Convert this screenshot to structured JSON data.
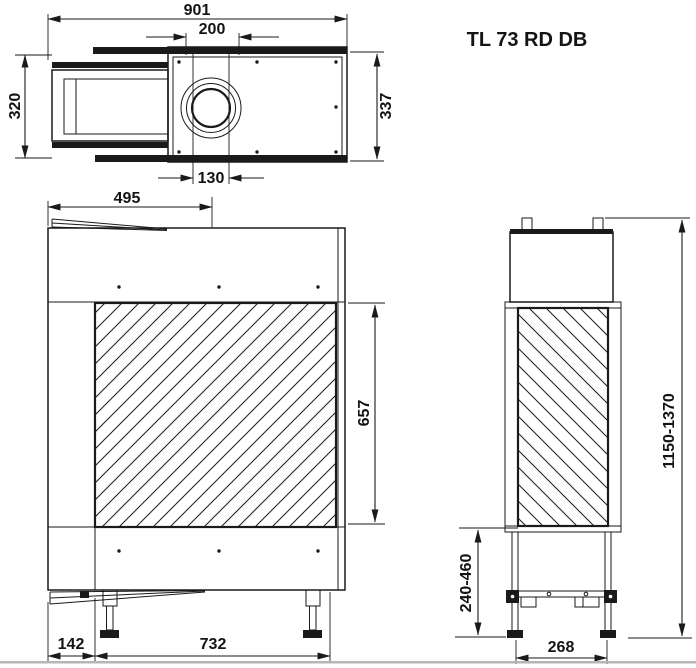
{
  "title": "TL 73 RD DB",
  "dimensions": {
    "top_view": {
      "overall_width": "901",
      "flue_collar_width": "200",
      "left_depth": "320",
      "right_depth": "337",
      "flue_inner_width": "130"
    },
    "front_view": {
      "flue_center_offset": "495",
      "glass_height": "657",
      "left_inset": "142",
      "base_width": "732"
    },
    "side_view": {
      "total_height_range": "1150-1370",
      "plinth_height_range": "240-460",
      "foot_spacing": "268"
    }
  }
}
